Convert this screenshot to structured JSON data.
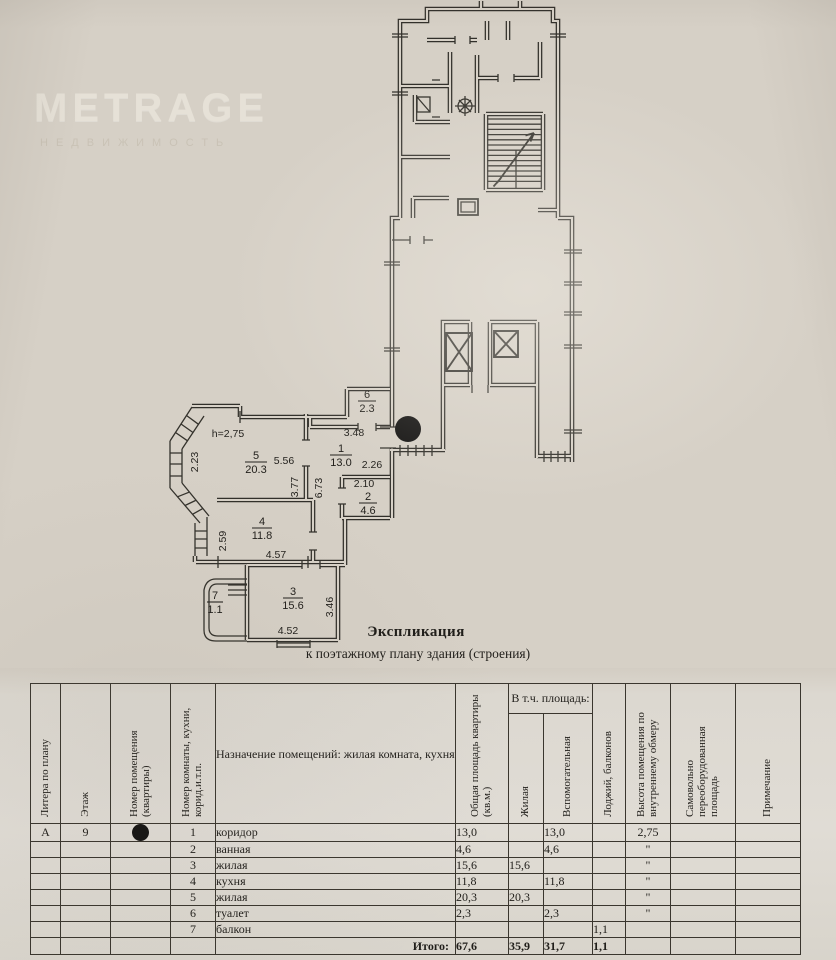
{
  "watermark": {
    "brand": "METRAGE",
    "subtitle": "НЕДВИЖИМОСТЬ"
  },
  "plan": {
    "ceiling_height_label": "h=2,75",
    "entrance_marker": "filled-circle",
    "rooms": [
      {
        "number": "1",
        "area": "13.0"
      },
      {
        "number": "2",
        "area": "4.6"
      },
      {
        "number": "3",
        "area": "15.6"
      },
      {
        "number": "4",
        "area": "11.8"
      },
      {
        "number": "5",
        "area": "20.3"
      },
      {
        "number": "6",
        "area": "2.3"
      },
      {
        "number": "7",
        "area": "1.1"
      }
    ],
    "dimensions": {
      "room5_left": "2.23",
      "room5_top": "5.56",
      "room5_right": "3.77",
      "corridor_length": "6.73",
      "corridor_top": "3.48",
      "corridor_mid": "2.26",
      "room2_top": "2.10",
      "room4_left": "2.59",
      "room4_width": "4.57",
      "room3_width": "4.52",
      "room3_height": "3.46"
    }
  },
  "title": {
    "heading": "Экспликация",
    "subheading": "к поэтажному плану здания (строения)"
  },
  "table": {
    "group_header": "В т.ч. площадь:",
    "headers": {
      "litera": "Литера по плану",
      "floor": "Этаж",
      "apartment": "Номер помещения (квартиры)",
      "room": "Номер комнаты, кухни, корид.и.т.п.",
      "purpose": "Назначение помещений: жилая комната, кухня и т.п.",
      "total_area": "Общая площадь квартиры (кв.м.)",
      "living": "Жилая",
      "auxiliary": "Вспомогательная",
      "loggia": "Лоджий, балконов",
      "height": "Высота помещения по внутреннему обмеру",
      "reequipped": "Самовольно переоборудованная площадь",
      "note": "Примечание"
    },
    "rows": [
      {
        "litera": "А",
        "floor": "9",
        "room_no": "1",
        "name": "коридор",
        "total": "13,0",
        "living": "",
        "aux": "13,0",
        "loggia": "",
        "height": "2,75",
        "reequipped": "",
        "note": ""
      },
      {
        "litera": "",
        "floor": "",
        "room_no": "2",
        "name": "ванная",
        "total": "4,6",
        "living": "",
        "aux": "4,6",
        "loggia": "",
        "height": "\"",
        "reequipped": "",
        "note": ""
      },
      {
        "litera": "",
        "floor": "",
        "room_no": "3",
        "name": "жилая",
        "total": "15,6",
        "living": "15,6",
        "aux": "",
        "loggia": "",
        "height": "\"",
        "reequipped": "",
        "note": ""
      },
      {
        "litera": "",
        "floor": "",
        "room_no": "4",
        "name": "кухня",
        "total": "11,8",
        "living": "",
        "aux": "11,8",
        "loggia": "",
        "height": "\"",
        "reequipped": "",
        "note": ""
      },
      {
        "litera": "",
        "floor": "",
        "room_no": "5",
        "name": "жилая",
        "total": "20,3",
        "living": "20,3",
        "aux": "",
        "loggia": "",
        "height": "\"",
        "reequipped": "",
        "note": ""
      },
      {
        "litera": "",
        "floor": "",
        "room_no": "6",
        "name": "туалет",
        "total": "2,3",
        "living": "",
        "aux": "2,3",
        "loggia": "",
        "height": "\"",
        "reequipped": "",
        "note": ""
      },
      {
        "litera": "",
        "floor": "",
        "room_no": "7",
        "name": "балкон",
        "total": "",
        "living": "",
        "aux": "",
        "loggia": "1,1",
        "height": "",
        "reequipped": "",
        "note": ""
      }
    ],
    "total_row": {
      "label": "Итого:",
      "total": "67,6",
      "living": "35,9",
      "aux": "31,7",
      "loggia": "1,1",
      "height": "",
      "reequipped": "",
      "note": ""
    }
  }
}
